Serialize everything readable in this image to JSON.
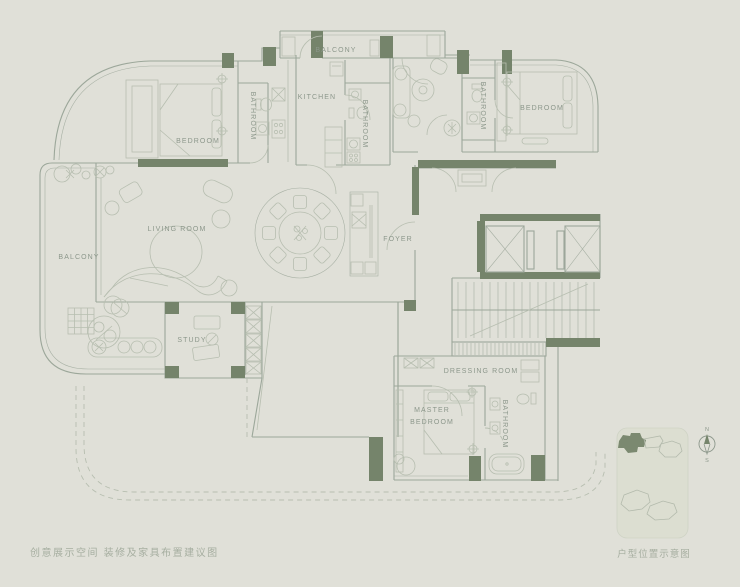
{
  "colors": {
    "background": "#e0e0d8",
    "line": "#9ca79a",
    "line_light": "#b7beb0",
    "wall_dark": "#75846b",
    "label": "#8c978b",
    "caption": "#a6aea0",
    "inset_bg": "#dcded1",
    "inset_outline": "#b3baac",
    "inset_highlight": "#7b8970"
  },
  "captions": {
    "bottom_left": "创意展示空间 装修及家具布置建议图",
    "inset": "户型位置示意图"
  },
  "compass": {
    "north": "N",
    "south": "S"
  },
  "rooms": [
    {
      "id": "balcony-top",
      "label": "BALCONY"
    },
    {
      "id": "kitchen",
      "label": "KITCHEN"
    },
    {
      "id": "bathroom-1",
      "label": "BATHROOM"
    },
    {
      "id": "bedroom-left",
      "label": "BEDROOM"
    },
    {
      "id": "bathroom-2",
      "label": "BATHROOM"
    },
    {
      "id": "bathroom-3",
      "label": "BATHROOM"
    },
    {
      "id": "bedroom-right",
      "label": "BEDROOM"
    },
    {
      "id": "living-room",
      "label": "LIVING ROOM"
    },
    {
      "id": "balcony-left",
      "label": "BALCONY"
    },
    {
      "id": "foyer",
      "label": "FOYER"
    },
    {
      "id": "study",
      "label": "STUDY"
    },
    {
      "id": "dressing-room",
      "label": "DRESSING ROOM"
    },
    {
      "id": "master-bedroom",
      "label": "MASTER",
      "label2": "BEDROOM"
    },
    {
      "id": "bathroom-master",
      "label": "BATHROOM"
    }
  ]
}
